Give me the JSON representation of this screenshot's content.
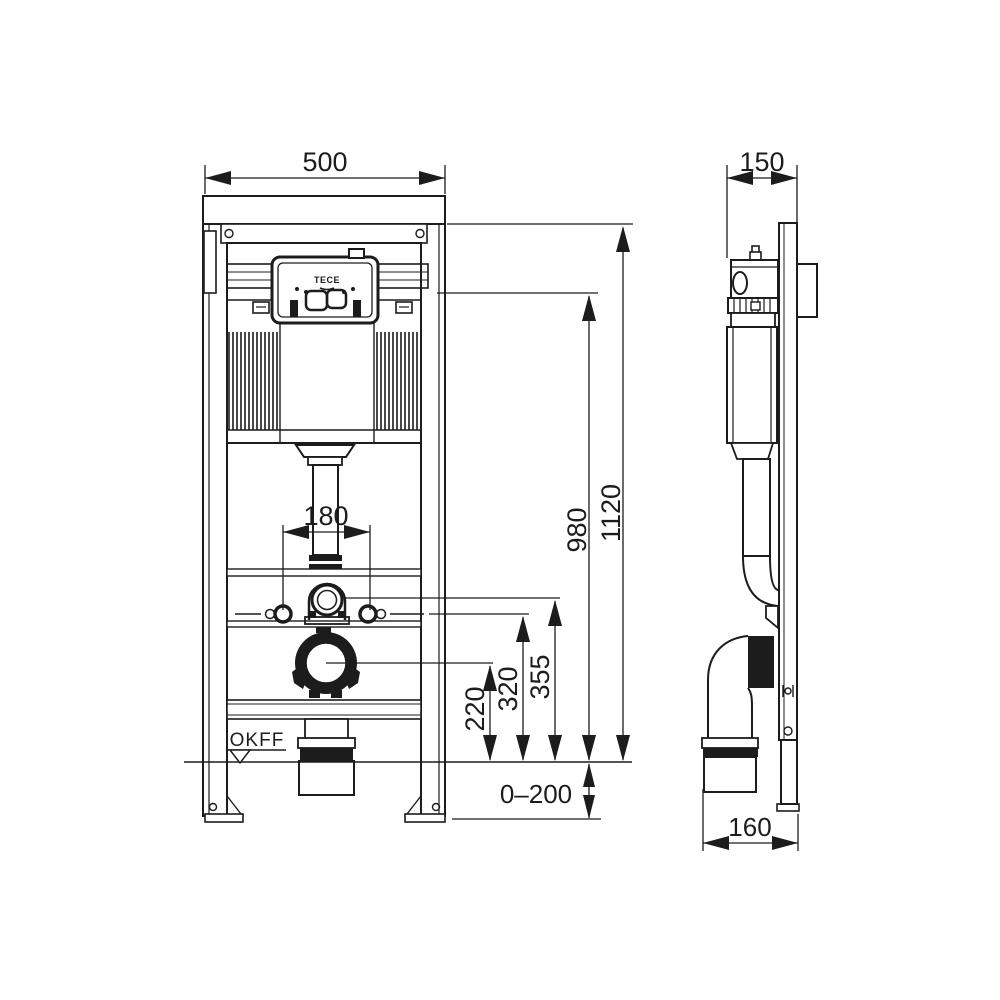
{
  "meta": {
    "type": "technical-dimension-drawing",
    "subject": "wall-mounted WC installation frame with concealed cistern",
    "views": [
      "front",
      "side"
    ]
  },
  "colors": {
    "line": "#1c1c1c",
    "background": "#ffffff"
  },
  "labels": {
    "frame_width": "500",
    "frame_depth": "150",
    "total_height": "1120",
    "actuator_height": "980",
    "bolt_spacing": "180",
    "drain_height": "220",
    "bolt_height": "320",
    "flush_pipe_height": "355",
    "foot_adjustment": "0–200",
    "drain_wall_offset": "160",
    "floor_level": "OKFF",
    "logo": "TECE"
  }
}
